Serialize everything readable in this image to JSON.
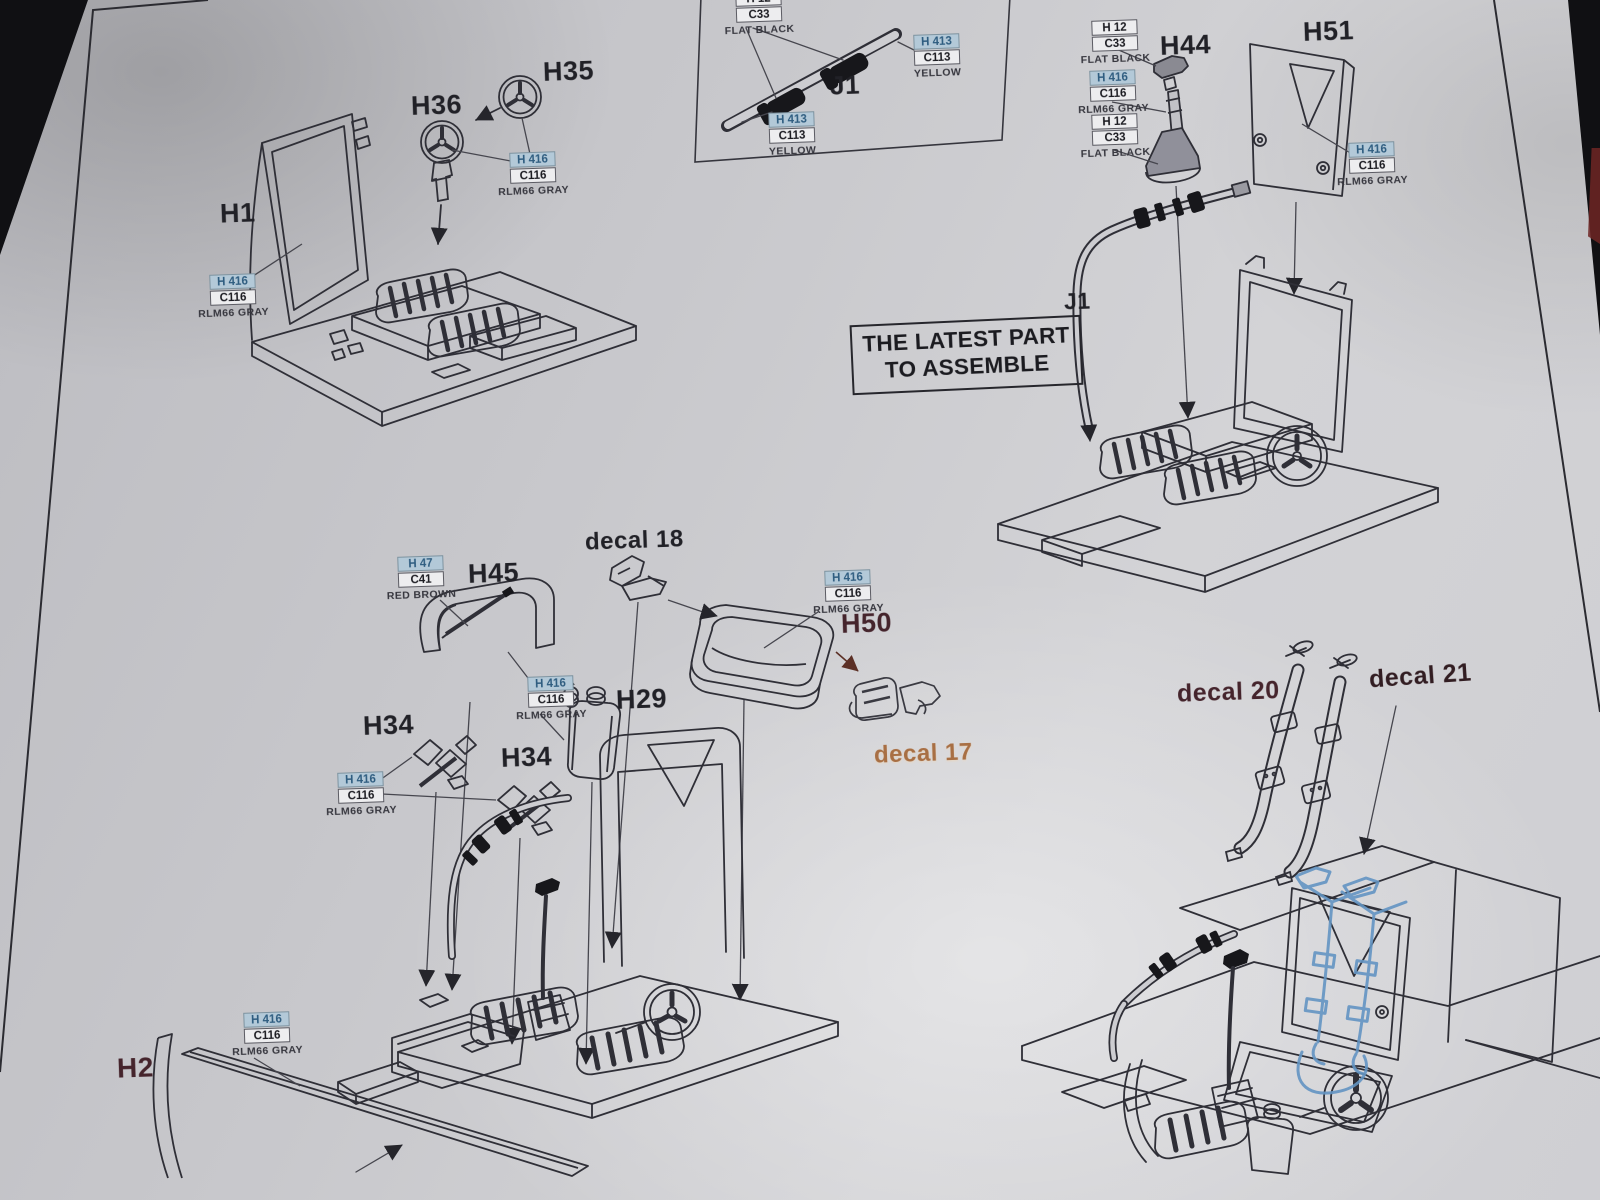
{
  "note": {
    "line1": "THE LATEST PART",
    "line2": "TO ASSEMBLE"
  },
  "parts": {
    "h1": "H1",
    "h2": "H2",
    "h29": "H29",
    "h34": "H34",
    "h35": "H35",
    "h36": "H36",
    "h44": "H44",
    "h45": "H45",
    "h50": "H50",
    "h51": "H51",
    "j1": "J1",
    "decal17": "decal 17",
    "decal18": "decal 18",
    "decal20": "decal 20",
    "decal21": "decal 21"
  },
  "paints": {
    "rlm66_gray": {
      "code1": "H 416",
      "code2": "C116",
      "name": "RLM66 GRAY"
    },
    "flat_black": {
      "code1": "H 12",
      "code2": "C33",
      "name": "FLAT BLACK"
    },
    "yellow": {
      "code1": "H 413",
      "code2": "C113",
      "name": "YELLOW"
    },
    "red_brown": {
      "code1": "H 47",
      "code2": "C41",
      "name": "RED BROWN"
    }
  },
  "colors": {
    "paint_code_highlight_bg": "#b3c9d8",
    "paint_code_highlight_text": "#2f5d80",
    "label_dark": "#212127",
    "label_maroon": "#45242c",
    "label_copper": "#a86f44",
    "seatbelt_blue": "#6394c2",
    "page_edge_red": "#6e2624"
  }
}
